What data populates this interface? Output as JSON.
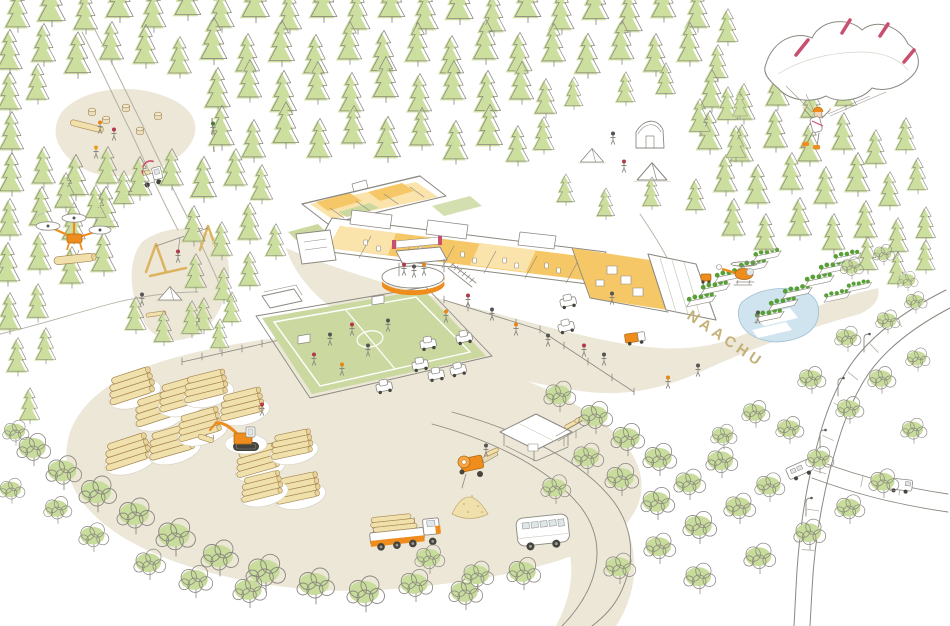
{
  "scene": {
    "path_label": "NAACHU",
    "colors": {
      "ink": "#8b8880",
      "ink_light": "#b5b1a4",
      "ground": "#ece7d7",
      "conifer": "#ccdf9f",
      "deciduous": "#c8dc9c",
      "grass": "#cbd9a0",
      "floor": "#f6c766",
      "floor_pale": "#fbe3ac",
      "accent": "#ee8d1d",
      "accent_dark": "#b0690f",
      "pink": "#c94f6e",
      "log": "#f0e0ac",
      "log_line": "#a5854f",
      "log_end": "#e8d49a",
      "pond": "#cfe4ef",
      "plant": "#57a035",
      "label": "#c2ae72",
      "glass": "#dfe6ea",
      "wheel": "#45433e",
      "wood": "#dcb45f"
    },
    "stamp_layers": [
      {
        "key": "conifers",
        "symbol": "sym-conifer",
        "name": "conifer-tree"
      },
      {
        "key": "deciduous",
        "symbol": "sym-deciduous",
        "name": "deciduous-tree"
      },
      {
        "key": "log_stacks",
        "symbol": "sym-logstack",
        "name": "log-stack"
      },
      {
        "key": "stumps",
        "symbol": "sym-stump",
        "name": "tree-stump"
      },
      {
        "key": "cars",
        "symbol": "sym-car",
        "name": "parked-car"
      },
      {
        "key": "garden_beds",
        "symbol": "sym-bed",
        "name": "garden-bed"
      },
      {
        "key": "tents",
        "symbol": "sym-tent",
        "name": "tent"
      },
      {
        "key": "fence_posts",
        "symbol": "sym-post",
        "name": "fence-post"
      },
      {
        "key": "road_ticks",
        "symbol": "sym-tick",
        "name": "road-marking"
      },
      {
        "key": "lamps",
        "symbol": "sym-lamp",
        "name": "street-lamp"
      },
      {
        "key": "people",
        "symbol": "sym-person",
        "name": "person"
      }
    ],
    "conifers": [
      [
        18,
        30,
        0.8
      ],
      [
        52,
        24,
        0.9
      ],
      [
        86,
        32,
        0.78
      ],
      [
        120,
        20,
        0.88
      ],
      [
        154,
        30,
        0.8
      ],
      [
        188,
        18,
        0.85
      ],
      [
        222,
        30,
        0.82
      ],
      [
        256,
        20,
        0.9
      ],
      [
        290,
        32,
        0.78
      ],
      [
        324,
        20,
        0.86
      ],
      [
        358,
        32,
        0.8
      ],
      [
        392,
        20,
        0.85
      ],
      [
        426,
        32,
        0.82
      ],
      [
        460,
        22,
        0.88
      ],
      [
        494,
        34,
        0.78
      ],
      [
        528,
        20,
        0.86
      ],
      [
        562,
        32,
        0.8
      ],
      [
        596,
        22,
        0.85
      ],
      [
        630,
        34,
        0.82
      ],
      [
        664,
        20,
        0.8
      ],
      [
        698,
        30,
        0.78
      ],
      [
        728,
        44,
        0.68
      ],
      [
        10,
        72,
        0.82
      ],
      [
        44,
        64,
        0.78
      ],
      [
        78,
        76,
        0.85
      ],
      [
        112,
        62,
        0.78
      ],
      [
        146,
        66,
        0.8
      ],
      [
        180,
        76,
        0.76
      ],
      [
        214,
        62,
        0.86
      ],
      [
        248,
        74,
        0.78
      ],
      [
        282,
        64,
        0.84
      ],
      [
        316,
        76,
        0.8
      ],
      [
        350,
        62,
        0.78
      ],
      [
        384,
        74,
        0.84
      ],
      [
        418,
        64,
        0.8
      ],
      [
        452,
        76,
        0.78
      ],
      [
        486,
        62,
        0.82
      ],
      [
        520,
        74,
        0.8
      ],
      [
        554,
        64,
        0.78
      ],
      [
        588,
        76,
        0.82
      ],
      [
        622,
        62,
        0.8
      ],
      [
        656,
        74,
        0.78
      ],
      [
        690,
        64,
        0.8
      ],
      [
        718,
        80,
        0.68
      ],
      [
        10,
        112,
        0.78
      ],
      [
        38,
        102,
        0.74
      ],
      [
        218,
        110,
        0.82
      ],
      [
        250,
        100,
        0.78
      ],
      [
        284,
        114,
        0.84
      ],
      [
        318,
        102,
        0.78
      ],
      [
        352,
        114,
        0.8
      ],
      [
        386,
        100,
        0.84
      ],
      [
        420,
        114,
        0.78
      ],
      [
        454,
        102,
        0.8
      ],
      [
        488,
        114,
        0.84
      ],
      [
        522,
        102,
        0.78
      ],
      [
        546,
        116,
        0.72
      ],
      [
        712,
        110,
        0.78
      ],
      [
        744,
        122,
        0.74
      ],
      [
        778,
        108,
        0.76
      ],
      [
        812,
        120,
        0.72
      ],
      [
        846,
        108,
        0.7
      ],
      [
        12,
        152,
        0.78
      ],
      [
        222,
        148,
        0.82
      ],
      [
        254,
        160,
        0.78
      ],
      [
        286,
        146,
        0.85
      ],
      [
        320,
        160,
        0.8
      ],
      [
        354,
        146,
        0.78
      ],
      [
        388,
        160,
        0.84
      ],
      [
        422,
        148,
        0.78
      ],
      [
        456,
        162,
        0.8
      ],
      [
        490,
        148,
        0.84
      ],
      [
        518,
        164,
        0.74
      ],
      [
        544,
        152,
        0.68
      ],
      [
        710,
        152,
        0.8
      ],
      [
        742,
        164,
        0.76
      ],
      [
        776,
        150,
        0.78
      ],
      [
        810,
        164,
        0.78
      ],
      [
        844,
        152,
        0.76
      ],
      [
        876,
        166,
        0.7
      ],
      [
        906,
        152,
        0.66
      ],
      [
        12,
        194,
        0.8
      ],
      [
        44,
        186,
        0.76
      ],
      [
        76,
        198,
        0.84
      ],
      [
        108,
        186,
        0.76
      ],
      [
        140,
        198,
        0.8
      ],
      [
        172,
        188,
        0.76
      ],
      [
        204,
        200,
        0.84
      ],
      [
        236,
        188,
        0.76
      ],
      [
        262,
        202,
        0.72
      ],
      [
        726,
        194,
        0.76
      ],
      [
        758,
        206,
        0.8
      ],
      [
        792,
        192,
        0.76
      ],
      [
        826,
        206,
        0.76
      ],
      [
        858,
        194,
        0.8
      ],
      [
        890,
        208,
        0.7
      ],
      [
        918,
        192,
        0.66
      ],
      [
        10,
        238,
        0.76
      ],
      [
        42,
        228,
        0.8
      ],
      [
        74,
        242,
        0.76
      ],
      [
        106,
        230,
        0.84
      ],
      [
        194,
        244,
        0.74
      ],
      [
        222,
        258,
        0.7
      ],
      [
        250,
        242,
        0.76
      ],
      [
        276,
        258,
        0.66
      ],
      [
        734,
        238,
        0.76
      ],
      [
        766,
        252,
        0.74
      ],
      [
        800,
        238,
        0.78
      ],
      [
        834,
        252,
        0.74
      ],
      [
        866,
        240,
        0.76
      ],
      [
        898,
        254,
        0.7
      ],
      [
        926,
        240,
        0.64
      ],
      [
        8,
        284,
        0.8
      ],
      [
        40,
        272,
        0.76
      ],
      [
        72,
        286,
        0.76
      ],
      [
        104,
        274,
        0.8
      ],
      [
        196,
        290,
        0.7
      ],
      [
        224,
        302,
        0.66
      ],
      [
        250,
        288,
        0.7
      ],
      [
        204,
        332,
        0.66
      ],
      [
        232,
        324,
        0.62
      ],
      [
        868,
        272,
        0.68
      ],
      [
        898,
        286,
        0.66
      ],
      [
        926,
        272,
        0.62
      ],
      [
        10,
        332,
        0.76
      ],
      [
        38,
        320,
        0.7
      ],
      [
        18,
        374,
        0.7
      ],
      [
        46,
        362,
        0.66
      ],
      [
        136,
        332,
        0.68
      ],
      [
        164,
        344,
        0.64
      ],
      [
        192,
        336,
        0.68
      ],
      [
        220,
        350,
        0.6
      ],
      [
        30,
        422,
        0.66
      ],
      [
        574,
        108,
        0.6
      ],
      [
        626,
        104,
        0.62
      ],
      [
        666,
        96,
        0.64
      ],
      [
        700,
        134,
        0.68
      ],
      [
        566,
        204,
        0.58
      ],
      [
        606,
        218,
        0.58
      ],
      [
        652,
        208,
        0.6
      ],
      [
        696,
        212,
        0.64
      ],
      [
        728,
        122,
        0.68
      ],
      [
        736,
        160,
        0.66
      ],
      [
        740,
        118,
        0.5
      ],
      [
        66,
        210,
        0.72
      ],
      [
        96,
        220,
        0.68
      ],
      [
        124,
        206,
        0.68
      ]
    ],
    "deciduous": [
      [
        34,
        464,
        0.9
      ],
      [
        64,
        488,
        0.95
      ],
      [
        98,
        510,
        1
      ],
      [
        136,
        532,
        1
      ],
      [
        176,
        554,
        1.05
      ],
      [
        220,
        574,
        1
      ],
      [
        266,
        590,
        1.05
      ],
      [
        316,
        602,
        1
      ],
      [
        366,
        610,
        1
      ],
      [
        150,
        578,
        0.85
      ],
      [
        196,
        596,
        0.9
      ],
      [
        250,
        606,
        0.9
      ],
      [
        94,
        550,
        0.8
      ],
      [
        58,
        522,
        0.75
      ],
      [
        16,
        444,
        0.7
      ],
      [
        12,
        502,
        0.7
      ],
      [
        416,
        600,
        0.9
      ],
      [
        466,
        608,
        0.9
      ],
      [
        430,
        572,
        0.8
      ],
      [
        478,
        590,
        0.85
      ],
      [
        524,
        588,
        0.9
      ],
      [
        560,
        410,
        0.85
      ],
      [
        596,
        432,
        0.9
      ],
      [
        628,
        454,
        0.9
      ],
      [
        660,
        474,
        0.9
      ],
      [
        588,
        472,
        0.85
      ],
      [
        622,
        494,
        0.9
      ],
      [
        556,
        502,
        0.8
      ],
      [
        658,
        518,
        0.9
      ],
      [
        690,
        498,
        0.85
      ],
      [
        722,
        476,
        0.85
      ],
      [
        700,
        542,
        0.9
      ],
      [
        740,
        522,
        0.85
      ],
      [
        770,
        500,
        0.8
      ],
      [
        660,
        562,
        0.85
      ],
      [
        620,
        582,
        0.85
      ],
      [
        700,
        592,
        0.85
      ],
      [
        760,
        572,
        0.85
      ],
      [
        810,
        548,
        0.85
      ],
      [
        850,
        522,
        0.8
      ],
      [
        884,
        496,
        0.8
      ],
      [
        820,
        472,
        0.75
      ],
      [
        790,
        442,
        0.75
      ],
      [
        850,
        422,
        0.75
      ],
      [
        882,
        392,
        0.75
      ],
      [
        914,
        442,
        0.7
      ],
      [
        918,
        370,
        0.65
      ],
      [
        848,
        350,
        0.7
      ],
      [
        888,
        332,
        0.65
      ],
      [
        916,
        312,
        0.6
      ],
      [
        812,
        392,
        0.75
      ],
      [
        756,
        426,
        0.75
      ],
      [
        724,
        448,
        0.7
      ],
      [
        852,
        278,
        0.62
      ],
      [
        884,
        264,
        0.58
      ],
      [
        908,
        290,
        0.55
      ]
    ],
    "log_stacks": [
      [
        132,
        392,
        1,
        -18
      ],
      [
        158,
        414,
        1,
        -18
      ],
      [
        182,
        400,
        1,
        -16
      ],
      [
        206,
        392,
        0.95,
        -14
      ],
      [
        128,
        458,
        1,
        -18
      ],
      [
        172,
        448,
        1,
        -16
      ],
      [
        200,
        430,
        0.95,
        -16
      ],
      [
        242,
        410,
        0.95,
        -14
      ],
      [
        258,
        466,
        0.95,
        -16
      ],
      [
        292,
        450,
        0.9,
        -12
      ],
      [
        298,
        494,
        0.95,
        -12
      ],
      [
        262,
        492,
        0.9,
        -14
      ]
    ],
    "stumps": [
      [
        92,
        113
      ],
      [
        106,
        121
      ],
      [
        126,
        109
      ],
      [
        140,
        132
      ],
      [
        158,
        117
      ]
    ],
    "cars": [
      [
        384,
        386,
        1,
        -12
      ],
      [
        420,
        364,
        1,
        -12
      ],
      [
        436,
        374,
        1,
        -10
      ],
      [
        458,
        369,
        1,
        -14
      ],
      [
        464,
        337,
        1,
        -12
      ],
      [
        428,
        343,
        1,
        -10
      ],
      [
        568,
        301,
        1,
        -12
      ],
      [
        566,
        326,
        1,
        -14
      ]
    ],
    "garden_beds": [
      [
        700,
        302,
        1,
        -12
      ],
      [
        714,
        290,
        1,
        -12
      ],
      [
        728,
        278,
        1,
        -12
      ],
      [
        752,
        268,
        1,
        -12
      ],
      [
        766,
        257,
        0.95,
        -12
      ],
      [
        768,
        318,
        1,
        -12
      ],
      [
        782,
        306,
        1,
        -12
      ],
      [
        796,
        294,
        1,
        -12
      ],
      [
        818,
        282,
        1,
        -12
      ],
      [
        832,
        270,
        1,
        -12
      ],
      [
        846,
        259,
        0.95,
        -12
      ],
      [
        836,
        298,
        0.9,
        -12
      ],
      [
        858,
        288,
        0.85,
        -12
      ]
    ],
    "tents": [
      [
        592,
        162,
        0.9
      ],
      [
        652,
        180,
        1.15
      ],
      [
        170,
        300,
        0.9
      ]
    ],
    "fence_posts": [
      [
        182,
        362
      ],
      [
        202,
        357
      ],
      [
        222,
        353
      ],
      [
        242,
        349
      ],
      [
        262,
        344
      ],
      [
        282,
        340
      ],
      [
        302,
        335
      ],
      [
        322,
        331
      ],
      [
        444,
        300
      ],
      [
        468,
        308
      ],
      [
        492,
        315
      ],
      [
        516,
        323
      ],
      [
        540,
        330
      ],
      [
        564,
        346
      ],
      [
        588,
        362
      ],
      [
        612,
        378
      ],
      [
        634,
        392
      ]
    ],
    "road_ticks": [
      [
        898,
        322,
        1,
        50
      ],
      [
        874,
        348,
        1,
        46
      ],
      [
        853,
        376,
        1,
        40
      ],
      [
        839,
        406,
        1,
        32
      ],
      [
        828,
        438,
        1,
        24
      ],
      [
        820,
        472,
        1,
        16
      ],
      [
        813,
        510,
        1,
        8
      ],
      [
        808,
        550,
        1,
        4
      ],
      [
        862,
        481,
        1,
        -78
      ],
      [
        900,
        489,
        1,
        -80
      ]
    ],
    "lamps": [
      [
        864,
        352
      ],
      [
        838,
        396
      ],
      [
        820,
        448
      ],
      [
        806,
        516
      ]
    ],
    "people": [
      [
        468,
        302,
        1,
        0,
        "#b03a4a"
      ],
      [
        492,
        316,
        1,
        0,
        "#555555"
      ],
      [
        516,
        331,
        1,
        0,
        "#e8861b"
      ],
      [
        548,
        342,
        1,
        0,
        "#555555"
      ],
      [
        584,
        352,
        1,
        0,
        "#b03a4a"
      ],
      [
        604,
        361,
        1,
        0,
        "#555555"
      ],
      [
        446,
        318,
        1,
        0,
        "#e8861b"
      ],
      [
        612,
        300,
        1,
        0,
        "#555555"
      ],
      [
        698,
        372,
        1,
        0,
        "#555555"
      ],
      [
        668,
        384,
        1,
        0,
        "#e8861b"
      ],
      [
        330,
        341,
        1,
        0,
        "#555555"
      ],
      [
        352,
        331,
        1,
        0,
        "#b03a4a"
      ],
      [
        368,
        352,
        1,
        0,
        "#555555"
      ],
      [
        314,
        361,
        1,
        0,
        "#b03a4a"
      ],
      [
        388,
        327,
        1,
        0,
        "#555555"
      ],
      [
        342,
        371,
        1,
        0,
        "#e8861b"
      ],
      [
        404,
        271,
        1,
        0,
        "#b03a4a"
      ],
      [
        414,
        273,
        1,
        0,
        "#555555"
      ],
      [
        424,
        271,
        1,
        0,
        "#e8861b"
      ],
      [
        100,
        129,
        1,
        0,
        "#e8861b"
      ],
      [
        114,
        136,
        1,
        0,
        "#b03a4a"
      ],
      [
        96,
        154,
        1,
        0,
        "#e8a11b"
      ],
      [
        213,
        130,
        1,
        0,
        "#4a7d3a"
      ],
      [
        178,
        258,
        1,
        0,
        "#b03a4a"
      ],
      [
        142,
        301,
        1,
        0,
        "#555555"
      ],
      [
        613,
        140,
        1,
        0,
        "#555555"
      ],
      [
        624,
        168,
        1,
        0,
        "#b03a4a"
      ],
      [
        262,
        411,
        1,
        0,
        "#b03a4a"
      ],
      [
        758,
        319,
        1,
        0,
        "#555555"
      ],
      [
        486,
        452,
        1,
        0,
        "#555555"
      ]
    ]
  }
}
